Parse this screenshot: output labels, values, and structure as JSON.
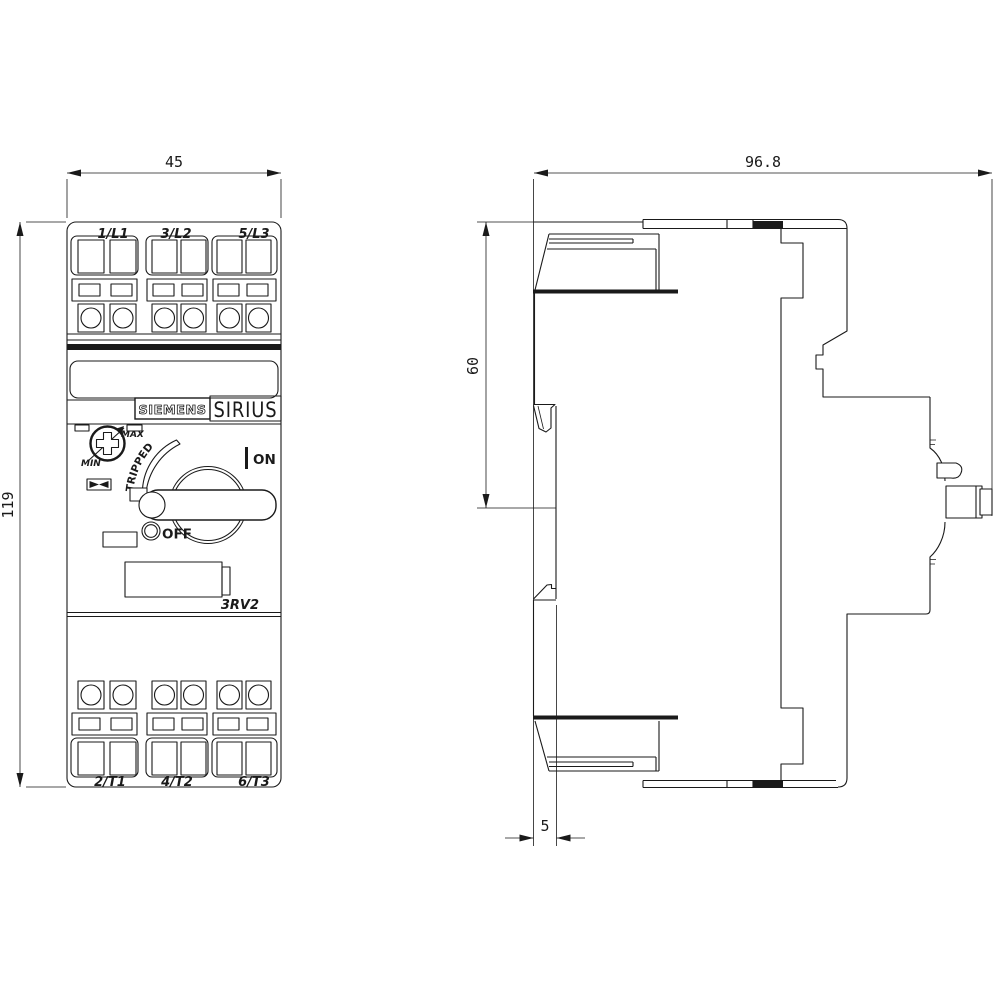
{
  "front_view": {
    "dim_width": "45",
    "dim_height": "119",
    "terminals_top": [
      "1/L1",
      "3/L2",
      "5/L3"
    ],
    "terminals_bottom": [
      "2/T1",
      "4/T2",
      "6/T3"
    ],
    "brand": "SIEMENS",
    "series": "SIRIUS",
    "model": "3RV2",
    "dial": {
      "min": "MIN",
      "max": "MAX"
    },
    "states": {
      "tripped": "TRIPPED",
      "on": "ON",
      "off": "OFF"
    }
  },
  "side_view": {
    "dim_depth": "96.8",
    "dim_height_upper": "60",
    "dim_rail_offset": "5"
  },
  "colors": {
    "line": "#1a1a1a",
    "background": "#ffffff"
  }
}
